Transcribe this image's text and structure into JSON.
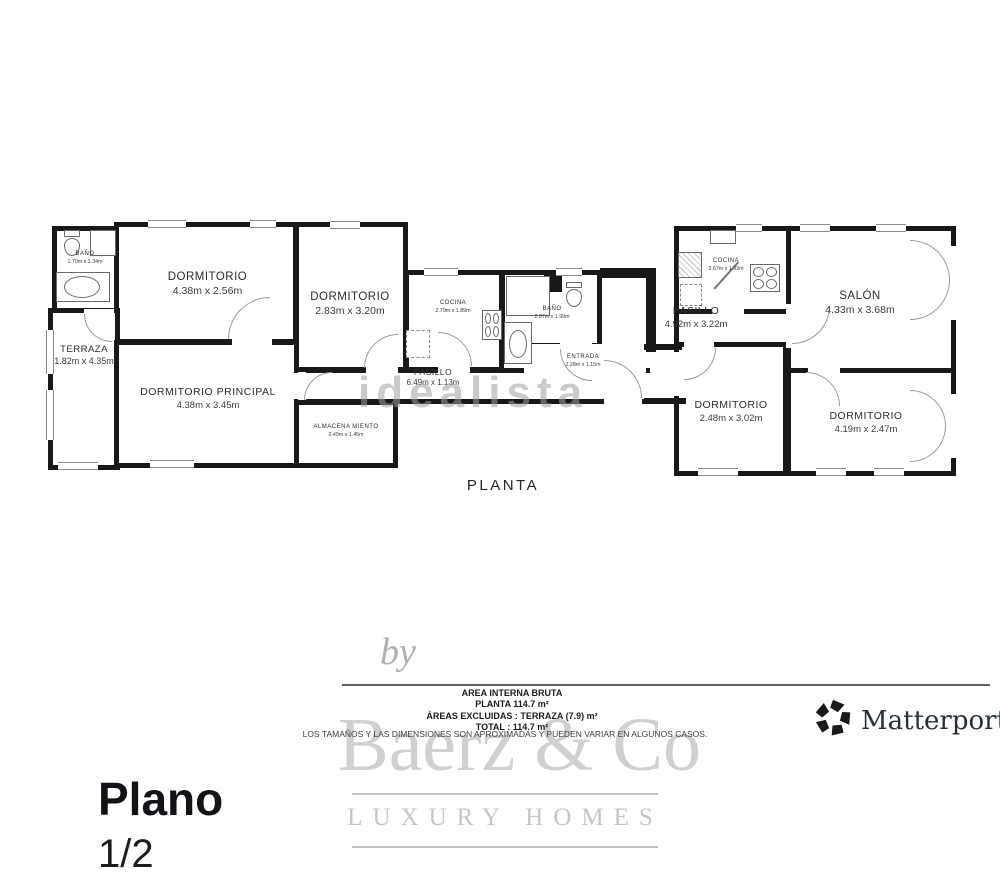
{
  "colors": {
    "wall": "#181818",
    "watermark_gray": "#c6c6c6",
    "text_dark": "#1c1c1c"
  },
  "floor_plan": {
    "title": "PLANTA",
    "watermark": "idealista",
    "rooms": {
      "bano1": {
        "name": "BAÑO",
        "dims": "1.70m x 1.34m"
      },
      "dormitorio1": {
        "name": "DORMITORIO",
        "dims": "4.38m x 2.56m"
      },
      "terraza": {
        "name": "TERRAZA",
        "dims": "1.82m x 4.35m"
      },
      "dormitorio_principal": {
        "name": "DORMITORIO PRINCIPAL",
        "dims": "4.38m x 3.45m"
      },
      "dormitorio2": {
        "name": "DORMITORIO",
        "dims": "2.83m x 3.20m"
      },
      "cocina1": {
        "name": "COCINA",
        "dims": "2.79m x 1.89m"
      },
      "pasillo1": {
        "name": "PASILLO",
        "dims": "6.49m x 1.13m"
      },
      "almacenamiento": {
        "name": "ALMACENA MIENTO",
        "dims": "2.49m x 1.45m"
      },
      "bano2": {
        "name": "BAÑO",
        "dims": "2.07m x 1.99m"
      },
      "entrada": {
        "name": "ENTRADA",
        "dims": "2.28m x 1.15m"
      },
      "cocina2": {
        "name": "COCINA",
        "dims": "3.67m x 1.93m"
      },
      "pasillo2": {
        "name": "PASILLO",
        "dims": "4.92m x 3.22m"
      },
      "salon": {
        "name": "SALÓN",
        "dims": "4.33m x 3.68m"
      },
      "dormitorio3": {
        "name": "DORMITORIO",
        "dims": "2.48m x 3.02m"
      },
      "dormitorio4": {
        "name": "DORMITORIO",
        "dims": "4.19m x 2.47m"
      }
    }
  },
  "area_summary": {
    "by_label": "by",
    "line1": "AREA INTERNA BRUTA",
    "line2": "PLANTA 114.7 m²",
    "line3": "ÁREAS EXCLUIDAS :  TERRAZA (7.9) m²",
    "line4": "TOTAL :  114.7 m²",
    "disclaimer": "LOS TAMAÑOS Y LAS DIMENSIONES SON APROXIMADAS Y PUEDEN VARIAR EN ALGUNOS CASOS."
  },
  "branding": {
    "agency_name": "Baerz & Co",
    "agency_tagline": "LUXURY HOMES",
    "matterport_label": "Matterport"
  },
  "footer": {
    "page_label": "Plano",
    "page_number": "1/2"
  }
}
